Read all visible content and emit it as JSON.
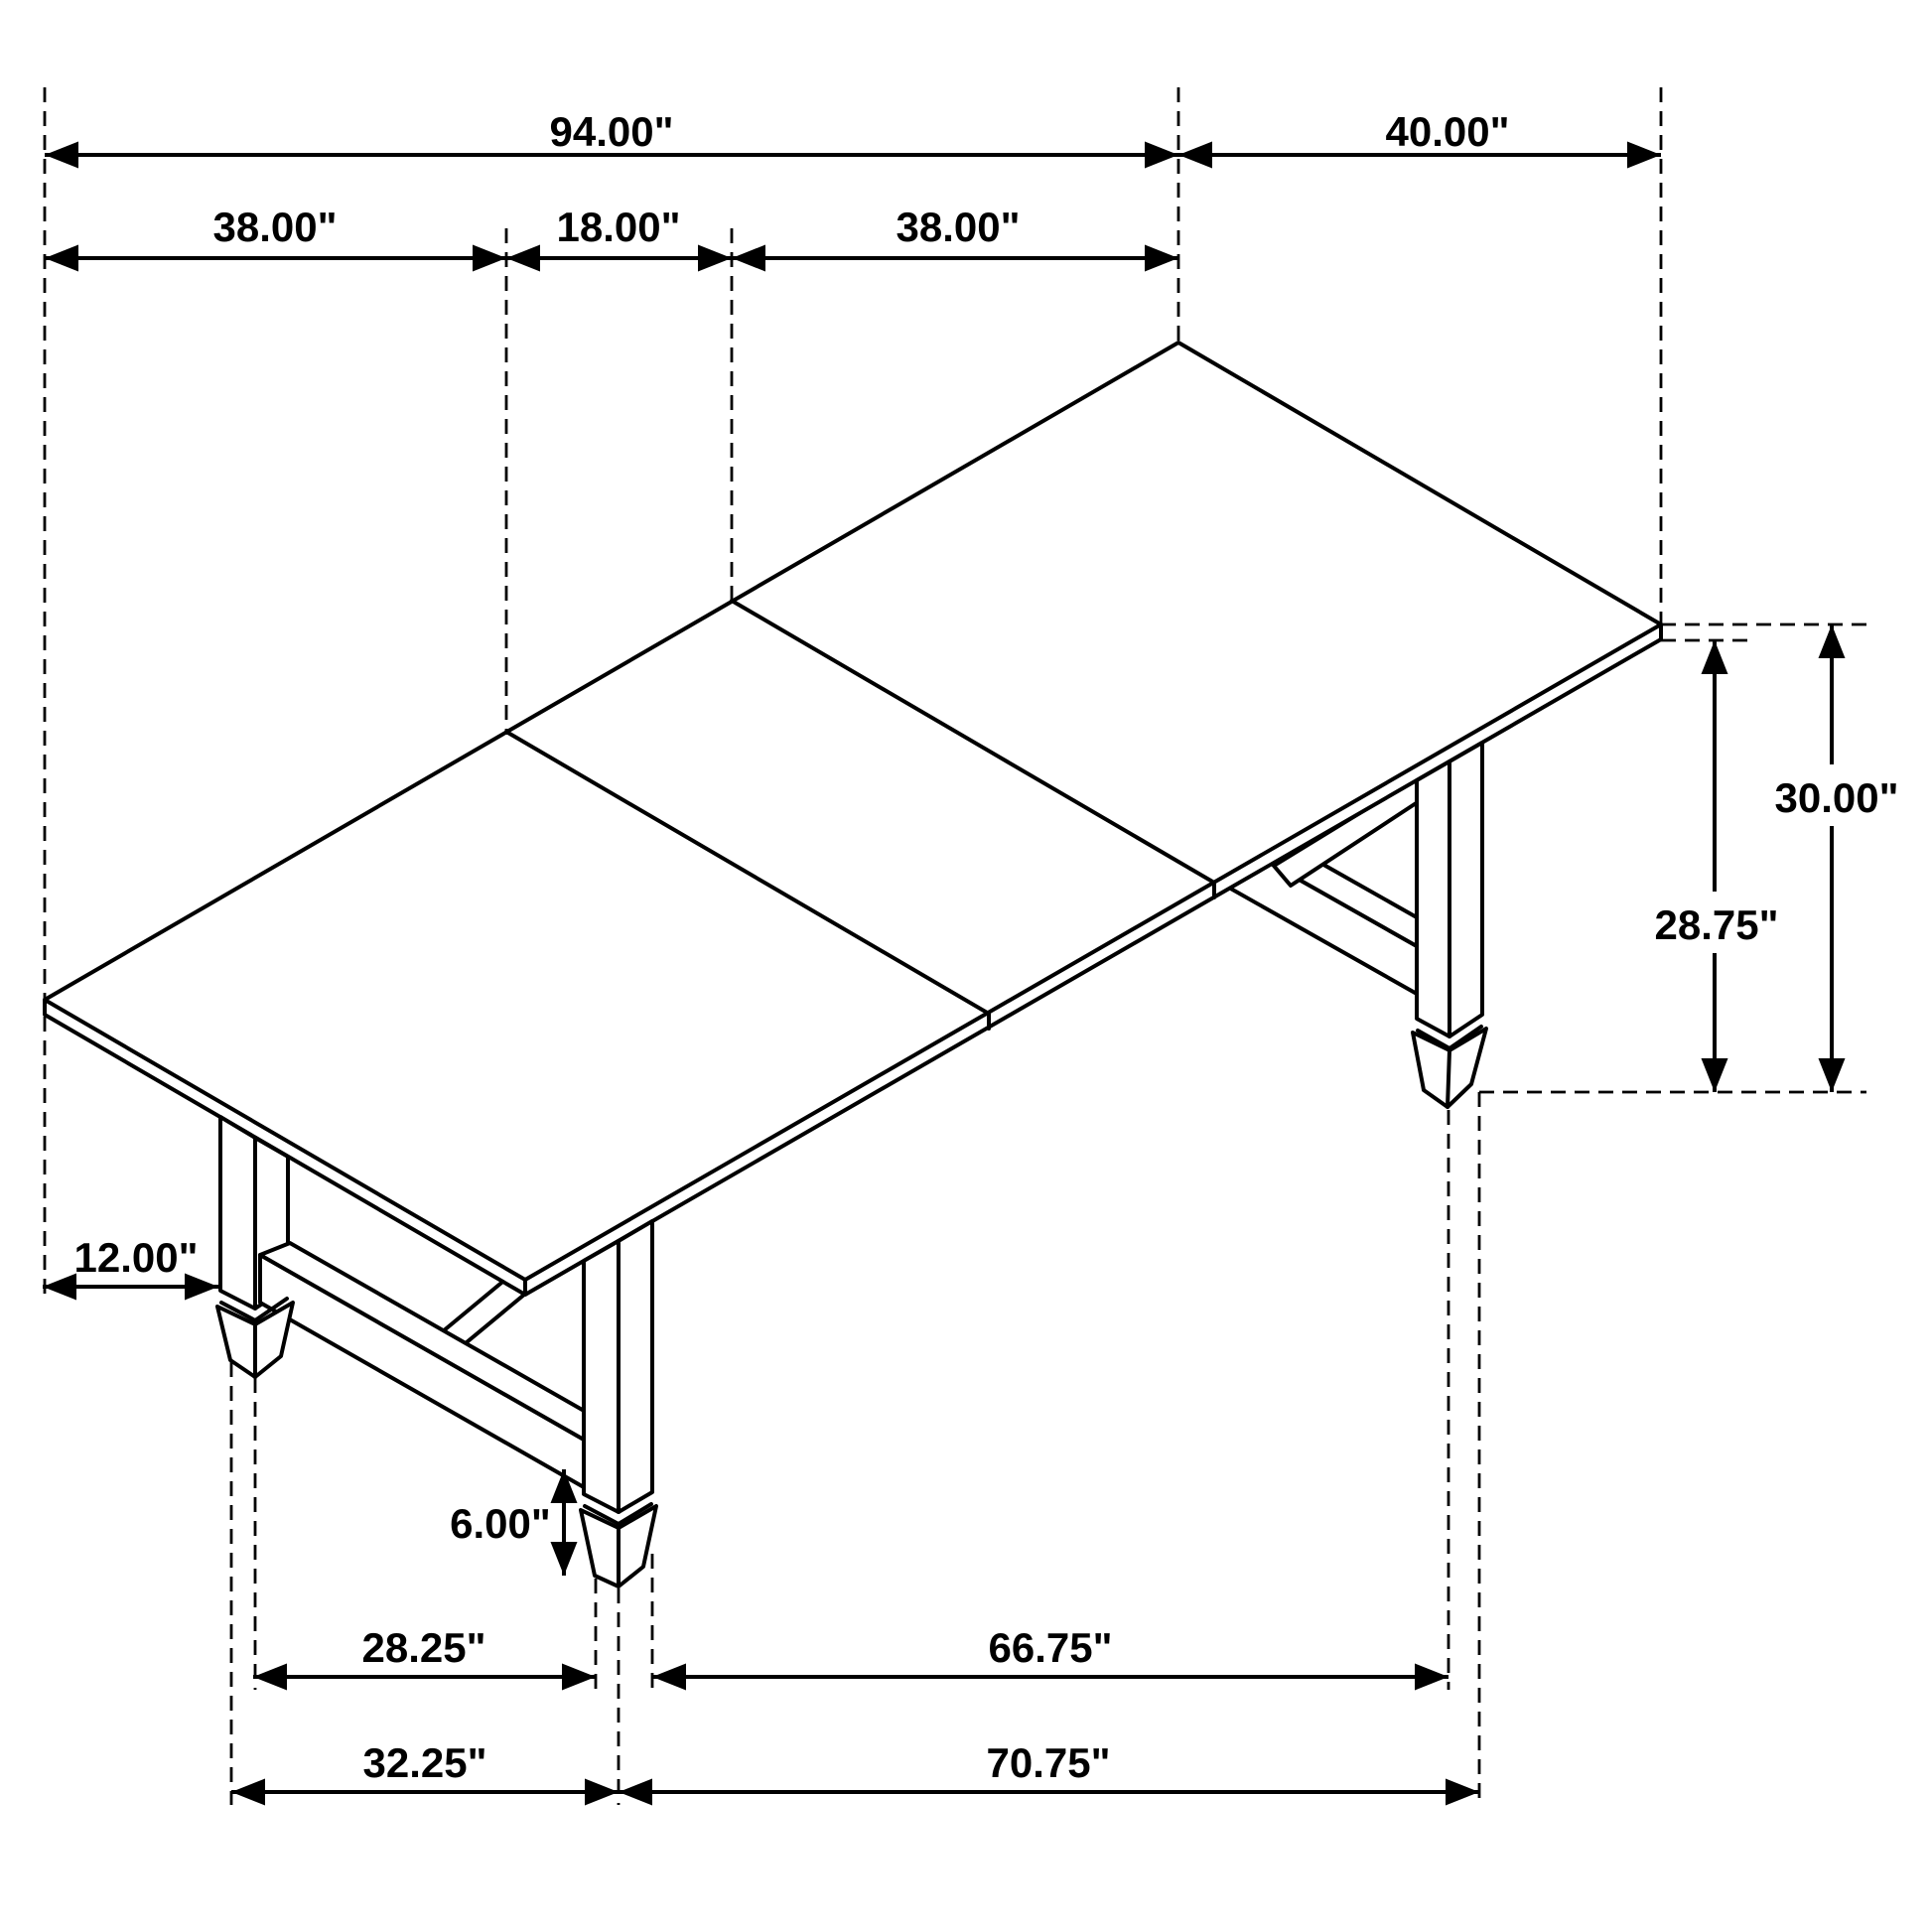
{
  "diagram": {
    "type": "isometric-dimension-drawing",
    "subject": "extension dining table with trestle base",
    "unit": "inches",
    "line_color": "#000000",
    "background_color": "#ffffff",
    "labels": {
      "overall_length": "94.00\"",
      "overall_width": "40.00\"",
      "end_section_left": "38.00\"",
      "center_leaf": "18.00\"",
      "end_section_right": "38.00\"",
      "height_overall": "30.00\"",
      "height_underside": "28.75\"",
      "leg_inset": "12.00\"",
      "stretcher_clearance": "6.00\"",
      "leg_gap_width_inner": "28.25\"",
      "leg_gap_length_inner": "66.75\"",
      "leg_gap_width_outer": "32.25\"",
      "leg_gap_length_outer": "70.75\""
    }
  }
}
